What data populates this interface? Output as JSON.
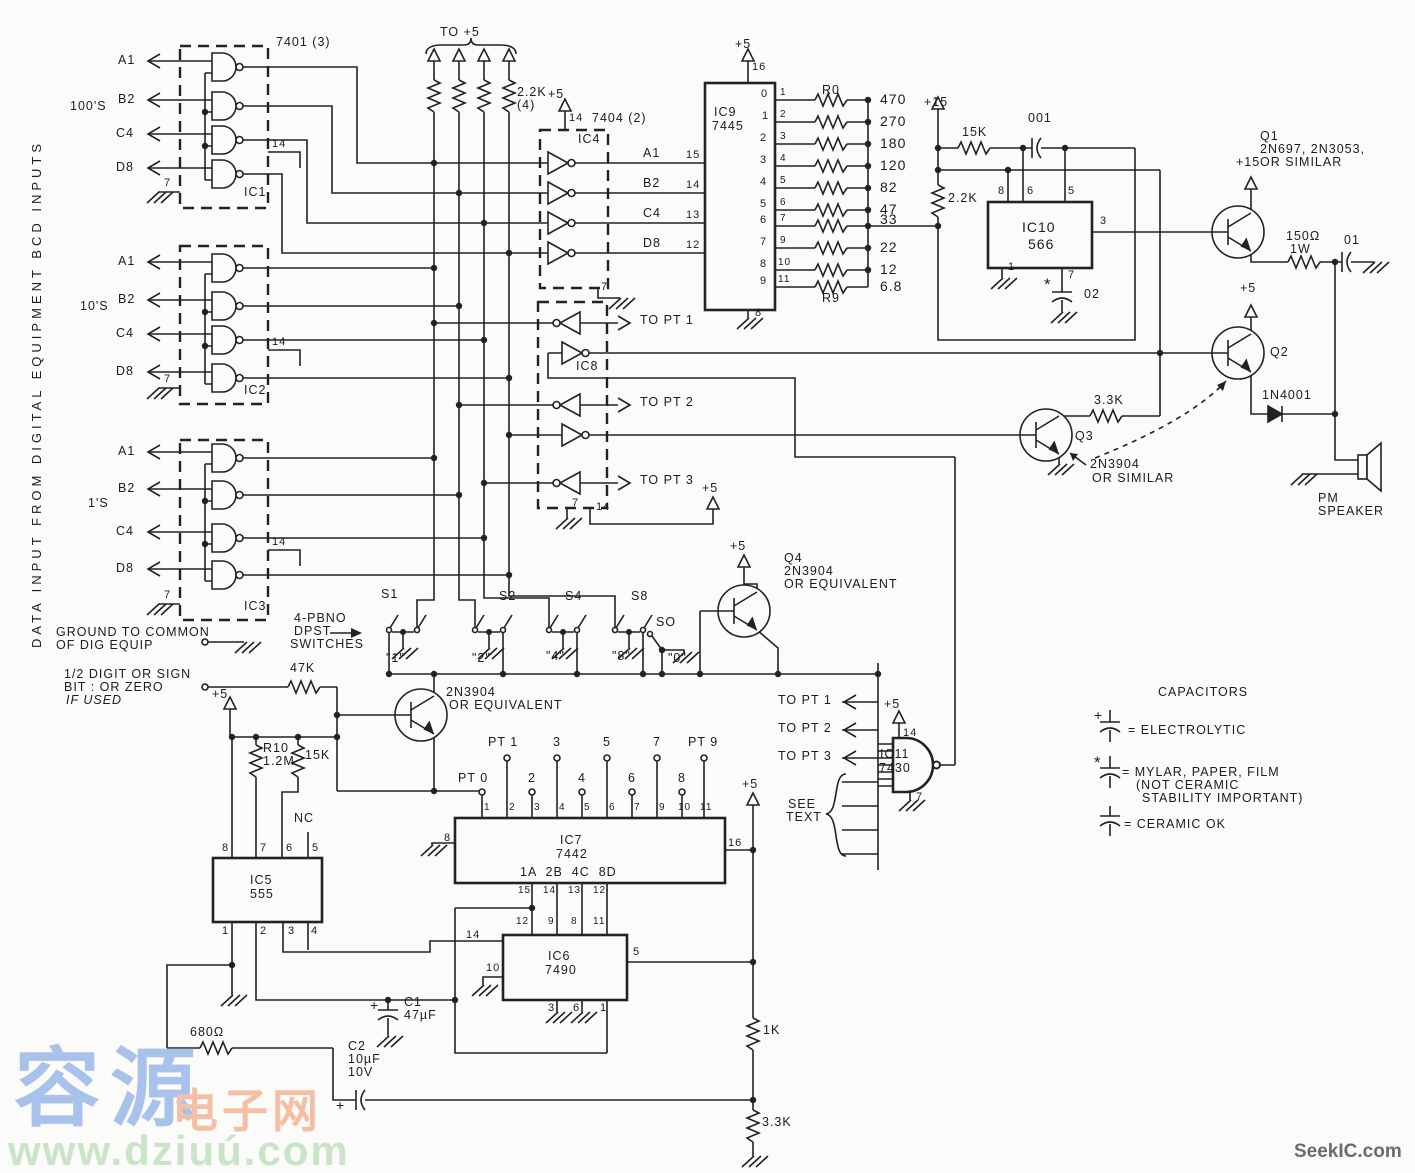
{
  "colors": {
    "ink": "#222222",
    "paper": "#fbfbfa",
    "wm_blue": "#a9c2ec",
    "wm_orange": "#f5bfa6",
    "wm_green": "#c9e4c7",
    "wm_gray": "#6b6b6b"
  },
  "watermarks": {
    "w1": "容源",
    "w2": "电子网",
    "w3": "www.dziuú.com",
    "w4": "SeekIC.com"
  },
  "labels": [
    {
      "n": "side-note",
      "t": "DATA INPUT FROM DIGITAL EQUIPMENT BCD INPUTS",
      "x": 30,
      "y": 648,
      "r": -90,
      "sp": 4,
      "s": 13
    },
    {
      "n": "group-100s",
      "t": "100'S",
      "x": 70,
      "y": 100
    },
    {
      "n": "group-10s",
      "t": "10'S",
      "x": 80,
      "y": 300
    },
    {
      "n": "group-1s",
      "t": "1'S",
      "x": 88,
      "y": 497
    },
    {
      "n": "in-a1-100",
      "t": "A1",
      "x": 118,
      "y": 54
    },
    {
      "n": "in-b2-100",
      "t": "B2",
      "x": 118,
      "y": 93
    },
    {
      "n": "in-c4-100",
      "t": "C4",
      "x": 116,
      "y": 127
    },
    {
      "n": "in-d8-100",
      "t": "D8",
      "x": 116,
      "y": 161
    },
    {
      "n": "in-a1-10",
      "t": "A1",
      "x": 118,
      "y": 255
    },
    {
      "n": "in-b2-10",
      "t": "B2",
      "x": 118,
      "y": 293
    },
    {
      "n": "in-c4-10",
      "t": "C4",
      "x": 116,
      "y": 327
    },
    {
      "n": "in-d8-10",
      "t": "D8",
      "x": 116,
      "y": 365
    },
    {
      "n": "in-a1-1",
      "t": "A1",
      "x": 118,
      "y": 445
    },
    {
      "n": "in-b2-1",
      "t": "B2",
      "x": 118,
      "y": 482
    },
    {
      "n": "in-c4-1",
      "t": "C4",
      "x": 116,
      "y": 525
    },
    {
      "n": "in-d8-1",
      "t": "D8",
      "x": 116,
      "y": 562
    },
    {
      "n": "part-7401",
      "t": "7401 (3)",
      "x": 276,
      "y": 36
    },
    {
      "n": "ic1",
      "t": "IC1",
      "x": 244,
      "y": 186
    },
    {
      "n": "ic2",
      "t": "IC2",
      "x": 244,
      "y": 384
    },
    {
      "n": "ic3",
      "t": "IC3",
      "x": 244,
      "y": 600
    },
    {
      "t": "14",
      "x": 272,
      "y": 139,
      "s": 11
    },
    {
      "t": "7",
      "x": 164,
      "y": 178,
      "s": 11
    },
    {
      "t": "14",
      "x": 272,
      "y": 337,
      "s": 11
    },
    {
      "t": "7",
      "x": 164,
      "y": 374,
      "s": 11
    },
    {
      "t": "14",
      "x": 272,
      "y": 537,
      "s": 11
    },
    {
      "t": "7",
      "x": 164,
      "y": 590,
      "s": 11
    },
    {
      "n": "to-plus5",
      "t": "TO +5",
      "x": 440,
      "y": 26
    },
    {
      "n": "r-pullup",
      "t": "2.2K",
      "x": 517,
      "y": 86
    },
    {
      "t": "(4)",
      "x": 517,
      "y": 99
    },
    {
      "t": "+5",
      "x": 548,
      "y": 88
    },
    {
      "t": "14",
      "x": 569,
      "y": 113,
      "s": 11
    },
    {
      "n": "part-7404",
      "t": "7404 (2)",
      "x": 592,
      "y": 112
    },
    {
      "n": "ic4",
      "t": "IC4",
      "x": 578,
      "y": 133
    },
    {
      "t": "7",
      "x": 601,
      "y": 282,
      "s": 11
    },
    {
      "t": "A1",
      "x": 643,
      "y": 147
    },
    {
      "t": "15",
      "x": 686,
      "y": 150,
      "s": 11
    },
    {
      "t": "B2",
      "x": 643,
      "y": 177
    },
    {
      "t": "14",
      "x": 686,
      "y": 180,
      "s": 11
    },
    {
      "t": "C4",
      "x": 643,
      "y": 207
    },
    {
      "t": "13",
      "x": 686,
      "y": 210,
      "s": 11
    },
    {
      "t": "D8",
      "x": 643,
      "y": 237
    },
    {
      "t": "12",
      "x": 686,
      "y": 240,
      "s": 11
    },
    {
      "t": "+5",
      "x": 735,
      "y": 38
    },
    {
      "t": "16",
      "x": 752,
      "y": 62,
      "s": 11
    },
    {
      "n": "ic9",
      "t": "IC9",
      "x": 714,
      "y": 106
    },
    {
      "n": "ic9-part",
      "t": "7445",
      "x": 712,
      "y": 120
    },
    {
      "t": "0",
      "x": 761,
      "y": 89,
      "s": 11
    },
    {
      "t": "1",
      "x": 762,
      "y": 111,
      "s": 11
    },
    {
      "t": "2",
      "x": 760,
      "y": 133,
      "s": 11
    },
    {
      "t": "3",
      "x": 760,
      "y": 155,
      "s": 11
    },
    {
      "t": "4",
      "x": 760,
      "y": 177,
      "s": 11
    },
    {
      "t": "5",
      "x": 760,
      "y": 199,
      "s": 11
    },
    {
      "t": "6",
      "x": 760,
      "y": 215,
      "s": 11
    },
    {
      "t": "7",
      "x": 760,
      "y": 237,
      "s": 11
    },
    {
      "t": "8",
      "x": 760,
      "y": 259,
      "s": 11
    },
    {
      "t": "9",
      "x": 760,
      "y": 276,
      "s": 11
    },
    {
      "t": "1",
      "x": 780,
      "y": 88,
      "s": 10
    },
    {
      "t": "2",
      "x": 780,
      "y": 110,
      "s": 10
    },
    {
      "t": "3",
      "x": 780,
      "y": 132,
      "s": 10
    },
    {
      "t": "4",
      "x": 780,
      "y": 154,
      "s": 10
    },
    {
      "t": "5",
      "x": 780,
      "y": 176,
      "s": 10
    },
    {
      "t": "6",
      "x": 780,
      "y": 198,
      "s": 10
    },
    {
      "t": "7",
      "x": 780,
      "y": 214,
      "s": 10
    },
    {
      "t": "9",
      "x": 780,
      "y": 236,
      "s": 10
    },
    {
      "t": "10",
      "x": 778,
      "y": 258,
      "s": 10
    },
    {
      "t": "11",
      "x": 778,
      "y": 275,
      "s": 10
    },
    {
      "t": "8",
      "x": 755,
      "y": 308,
      "s": 11
    },
    {
      "n": "r0",
      "t": "R0",
      "x": 822,
      "y": 84
    },
    {
      "n": "r9",
      "t": "R9",
      "x": 822,
      "y": 292
    },
    {
      "n": "rv-470",
      "t": "470",
      "x": 880,
      "y": 92,
      "s": 14
    },
    {
      "n": "rv-270",
      "t": "270",
      "x": 880,
      "y": 114,
      "s": 14
    },
    {
      "n": "rv-180",
      "t": "180",
      "x": 880,
      "y": 136,
      "s": 14
    },
    {
      "n": "rv-120",
      "t": "120",
      "x": 880,
      "y": 158,
      "s": 14
    },
    {
      "n": "rv-82",
      "t": "82",
      "x": 880,
      "y": 180,
      "s": 14
    },
    {
      "n": "rv-47",
      "t": "47",
      "x": 880,
      "y": 202,
      "s": 14
    },
    {
      "n": "rv-33",
      "t": "33",
      "x": 880,
      "y": 212,
      "s": 14
    },
    {
      "n": "rv-22",
      "t": "22",
      "x": 880,
      "y": 240,
      "s": 14
    },
    {
      "n": "rv-12",
      "t": "12",
      "x": 880,
      "y": 262,
      "s": 14
    },
    {
      "n": "rv-68",
      "t": "6.8",
      "x": 880,
      "y": 279,
      "s": 14
    },
    {
      "t": "+15",
      "x": 924,
      "y": 96
    },
    {
      "n": "r-15k",
      "t": "15K",
      "x": 962,
      "y": 126
    },
    {
      "n": "c-001",
      "t": "001",
      "x": 1028,
      "y": 112
    },
    {
      "n": "r-22k",
      "t": "2.2K",
      "x": 948,
      "y": 192
    },
    {
      "n": "ic10",
      "t": "IC10",
      "x": 1022,
      "y": 220,
      "s": 14
    },
    {
      "n": "ic10-part",
      "t": "566",
      "x": 1028,
      "y": 237,
      "s": 14
    },
    {
      "t": "8",
      "x": 998,
      "y": 186,
      "s": 11
    },
    {
      "t": "6",
      "x": 1027,
      "y": 186,
      "s": 11
    },
    {
      "t": "5",
      "x": 1068,
      "y": 186,
      "s": 11
    },
    {
      "t": "3",
      "x": 1100,
      "y": 216,
      "s": 11
    },
    {
      "t": "1",
      "x": 1008,
      "y": 262,
      "s": 11
    },
    {
      "t": "7",
      "x": 1068,
      "y": 270,
      "s": 11
    },
    {
      "t": "*",
      "x": 1044,
      "y": 276,
      "s": 17
    },
    {
      "n": "c-02",
      "t": "02",
      "x": 1084,
      "y": 288
    },
    {
      "n": "q1",
      "t": "Q1",
      "x": 1260,
      "y": 130
    },
    {
      "t": "2N697, 2N3053,",
      "x": 1260,
      "y": 143
    },
    {
      "t": "OR SIMILAR",
      "x": 1260,
      "y": 156
    },
    {
      "t": "+15",
      "x": 1236,
      "y": 156
    },
    {
      "n": "r-150",
      "t": "150Ω",
      "x": 1286,
      "y": 230
    },
    {
      "t": "1W",
      "x": 1290,
      "y": 243
    },
    {
      "n": "c-01",
      "t": "01",
      "x": 1344,
      "y": 234
    },
    {
      "t": "+5",
      "x": 1240,
      "y": 282
    },
    {
      "n": "q2",
      "t": "Q2",
      "x": 1270,
      "y": 346
    },
    {
      "n": "d-1n4001",
      "t": "1N4001",
      "x": 1262,
      "y": 389
    },
    {
      "n": "speaker",
      "t": "PM",
      "x": 1318,
      "y": 492
    },
    {
      "t": "SPEAKER",
      "x": 1318,
      "y": 505
    },
    {
      "n": "r-33k",
      "t": "3.3K",
      "x": 1094,
      "y": 394
    },
    {
      "n": "q3",
      "t": "Q3",
      "x": 1075,
      "y": 430
    },
    {
      "t": "2N3904",
      "x": 1090,
      "y": 458
    },
    {
      "t": "OR SIMILAR",
      "x": 1092,
      "y": 472
    },
    {
      "n": "ic8",
      "t": "IC8",
      "x": 576,
      "y": 360
    },
    {
      "n": "to-pt1",
      "t": "TO PT 1",
      "x": 640,
      "y": 314
    },
    {
      "n": "to-pt2",
      "t": "TO PT 2",
      "x": 640,
      "y": 396
    },
    {
      "n": "to-pt3",
      "t": "TO PT 3",
      "x": 640,
      "y": 474
    },
    {
      "t": "7",
      "x": 572,
      "y": 498,
      "s": 11
    },
    {
      "t": "14",
      "x": 596,
      "y": 502,
      "s": 11
    },
    {
      "t": "+5",
      "x": 702,
      "y": 482
    },
    {
      "n": "s1",
      "t": "S1",
      "x": 381,
      "y": 588
    },
    {
      "n": "s2",
      "t": "S2",
      "x": 499,
      "y": 590
    },
    {
      "n": "s4",
      "t": "S4",
      "x": 565,
      "y": 590
    },
    {
      "n": "s8",
      "t": "S8",
      "x": 631,
      "y": 590
    },
    {
      "n": "so",
      "t": "SO",
      "x": 656,
      "y": 616
    },
    {
      "t": "\"1\"",
      "x": 386,
      "y": 652
    },
    {
      "t": "\"2\"",
      "x": 472,
      "y": 652
    },
    {
      "t": "\"4\"",
      "x": 546,
      "y": 650
    },
    {
      "t": "\"8\"",
      "x": 612,
      "y": 650
    },
    {
      "t": "\"0\"",
      "x": 668,
      "y": 652
    },
    {
      "t": "4-PBNO",
      "x": 294,
      "y": 612
    },
    {
      "t": "DPST",
      "x": 294,
      "y": 625
    },
    {
      "t": "SWITCHES",
      "x": 290,
      "y": 638
    },
    {
      "t": "GROUND TO COMMON",
      "x": 56,
      "y": 626
    },
    {
      "t": "OF DIG EQUIP",
      "x": 56,
      "y": 639
    },
    {
      "t": "1/2 DIGIT OR SIGN",
      "x": 64,
      "y": 668
    },
    {
      "t": "BIT : OR ZERO",
      "x": 64,
      "y": 681
    },
    {
      "t": "IF USED",
      "x": 66,
      "y": 694,
      "i": 1
    },
    {
      "n": "r-47k",
      "t": "47K",
      "x": 290,
      "y": 662
    },
    {
      "n": "q5-type",
      "t": "2N3904",
      "x": 446,
      "y": 686
    },
    {
      "t": "OR EQUIVALENT",
      "x": 449,
      "y": 699
    },
    {
      "t": "+5",
      "x": 730,
      "y": 540
    },
    {
      "n": "q4",
      "t": "Q4",
      "x": 784,
      "y": 552
    },
    {
      "t": "2N3904",
      "x": 784,
      "y": 565
    },
    {
      "t": "OR EQUIVALENT",
      "x": 784,
      "y": 578
    },
    {
      "t": "TO PT 1",
      "x": 778,
      "y": 694
    },
    {
      "t": "TO PT 2",
      "x": 778,
      "y": 722
    },
    {
      "t": "TO PT 3",
      "x": 778,
      "y": 750
    },
    {
      "t": "+5",
      "x": 884,
      "y": 698
    },
    {
      "t": "14",
      "x": 903,
      "y": 728,
      "s": 11
    },
    {
      "t": "7",
      "x": 916,
      "y": 792,
      "s": 11
    },
    {
      "n": "ic11",
      "t": "IC11",
      "x": 880,
      "y": 748
    },
    {
      "n": "ic11-part",
      "t": "7430",
      "x": 879,
      "y": 762
    },
    {
      "t": "SEE",
      "x": 788,
      "y": 798
    },
    {
      "t": "TEXT",
      "x": 786,
      "y": 811
    },
    {
      "n": "legend-title",
      "t": "CAPACITORS",
      "x": 1158,
      "y": 686
    },
    {
      "t": "+",
      "x": 1094,
      "y": 708,
      "s": 14
    },
    {
      "t": "= ELECTROLYTIC",
      "x": 1128,
      "y": 724
    },
    {
      "t": "*",
      "x": 1094,
      "y": 754,
      "s": 17
    },
    {
      "t": "= MYLAR, PAPER, FILM",
      "x": 1122,
      "y": 766
    },
    {
      "t": "(NOT CERAMIC",
      "x": 1136,
      "y": 779
    },
    {
      "t": "STABILITY IMPORTANT)",
      "x": 1142,
      "y": 792
    },
    {
      "t": "= CERAMIC OK",
      "x": 1124,
      "y": 818
    },
    {
      "t": "+5",
      "x": 212,
      "y": 688
    },
    {
      "n": "r10",
      "t": "R10",
      "x": 263,
      "y": 742
    },
    {
      "t": "1.2M",
      "x": 263,
      "y": 755
    },
    {
      "n": "r-15k-b",
      "t": "15K",
      "x": 305,
      "y": 749
    },
    {
      "t": "NC",
      "x": 294,
      "y": 812
    },
    {
      "n": "ic5",
      "t": "IC5",
      "x": 250,
      "y": 874
    },
    {
      "n": "ic5-part",
      "t": "555",
      "x": 250,
      "y": 888
    },
    {
      "t": "8",
      "x": 222,
      "y": 843,
      "s": 11
    },
    {
      "t": "7",
      "x": 260,
      "y": 843,
      "s": 11
    },
    {
      "t": "6",
      "x": 286,
      "y": 843,
      "s": 11
    },
    {
      "t": "5",
      "x": 312,
      "y": 843,
      "s": 11
    },
    {
      "t": "1",
      "x": 222,
      "y": 926,
      "s": 11
    },
    {
      "t": "2",
      "x": 260,
      "y": 926,
      "s": 11
    },
    {
      "t": "3",
      "x": 288,
      "y": 926,
      "s": 11
    },
    {
      "t": "4",
      "x": 311,
      "y": 926,
      "s": 11
    },
    {
      "n": "ic7",
      "t": "IC7",
      "x": 560,
      "y": 834
    },
    {
      "n": "ic7-part",
      "t": "7442",
      "x": 556,
      "y": 848
    },
    {
      "t": "1A  2B  4C  8D",
      "x": 520,
      "y": 866
    },
    {
      "n": "pt0",
      "t": "PT 0",
      "x": 458,
      "y": 772
    },
    {
      "n": "pt1",
      "t": "PT 1",
      "x": 488,
      "y": 736
    },
    {
      "t": "2",
      "x": 528,
      "y": 772
    },
    {
      "t": "3",
      "x": 553,
      "y": 736
    },
    {
      "t": "4",
      "x": 578,
      "y": 772
    },
    {
      "t": "5",
      "x": 603,
      "y": 736
    },
    {
      "t": "6",
      "x": 628,
      "y": 772
    },
    {
      "t": "7",
      "x": 653,
      "y": 736
    },
    {
      "t": "8",
      "x": 678,
      "y": 772
    },
    {
      "n": "pt9",
      "t": "PT 9",
      "x": 688,
      "y": 736
    },
    {
      "t": "1",
      "x": 484,
      "y": 803,
      "s": 10
    },
    {
      "t": "2",
      "x": 509,
      "y": 803,
      "s": 10
    },
    {
      "t": "3",
      "x": 534,
      "y": 803,
      "s": 10
    },
    {
      "t": "4",
      "x": 559,
      "y": 803,
      "s": 10
    },
    {
      "t": "5",
      "x": 584,
      "y": 803,
      "s": 10
    },
    {
      "t": "6",
      "x": 609,
      "y": 803,
      "s": 10
    },
    {
      "t": "7",
      "x": 634,
      "y": 803,
      "s": 10
    },
    {
      "t": "9",
      "x": 659,
      "y": 803,
      "s": 10
    },
    {
      "t": "10",
      "x": 678,
      "y": 803,
      "s": 10
    },
    {
      "t": "11",
      "x": 700,
      "y": 803,
      "s": 10
    },
    {
      "t": "15",
      "x": 518,
      "y": 886,
      "s": 10
    },
    {
      "t": "14",
      "x": 543,
      "y": 886,
      "s": 10
    },
    {
      "t": "13",
      "x": 568,
      "y": 886,
      "s": 10
    },
    {
      "t": "12",
      "x": 593,
      "y": 886,
      "s": 10
    },
    {
      "t": "8",
      "x": 444,
      "y": 833,
      "s": 11
    },
    {
      "t": "16",
      "x": 728,
      "y": 838,
      "s": 11
    },
    {
      "t": "+5",
      "x": 742,
      "y": 778
    },
    {
      "t": "12",
      "x": 516,
      "y": 917,
      "s": 10
    },
    {
      "t": "9",
      "x": 548,
      "y": 917,
      "s": 10
    },
    {
      "t": "8",
      "x": 571,
      "y": 917,
      "s": 10
    },
    {
      "t": "11",
      "x": 593,
      "y": 917,
      "s": 10
    },
    {
      "t": "14",
      "x": 466,
      "y": 930,
      "s": 11
    },
    {
      "t": "10",
      "x": 486,
      "y": 963,
      "s": 11
    },
    {
      "n": "ic6",
      "t": "IC6",
      "x": 548,
      "y": 950
    },
    {
      "n": "ic6-part",
      "t": "7490",
      "x": 545,
      "y": 964
    },
    {
      "t": "5",
      "x": 633,
      "y": 947,
      "s": 11
    },
    {
      "t": "3",
      "x": 548,
      "y": 1003,
      "s": 11
    },
    {
      "t": "6",
      "x": 573,
      "y": 1003,
      "s": 11
    },
    {
      "t": "1",
      "x": 600,
      "y": 1003,
      "s": 11
    },
    {
      "n": "c1",
      "t": "C1",
      "x": 404,
      "y": 996
    },
    {
      "t": "47µF",
      "x": 404,
      "y": 1009
    },
    {
      "t": "+",
      "x": 370,
      "y": 998,
      "s": 14
    },
    {
      "n": "c2",
      "t": "C2",
      "x": 348,
      "y": 1040
    },
    {
      "t": "10µF",
      "x": 348,
      "y": 1053
    },
    {
      "t": "10V",
      "x": 348,
      "y": 1066
    },
    {
      "t": "+",
      "x": 336,
      "y": 1098,
      "s": 14
    },
    {
      "n": "r-680",
      "t": "680Ω",
      "x": 190,
      "y": 1026
    },
    {
      "n": "r-1k",
      "t": "1K",
      "x": 763,
      "y": 1024
    },
    {
      "n": "r-33k-b",
      "t": "3.3K",
      "x": 762,
      "y": 1116
    }
  ]
}
